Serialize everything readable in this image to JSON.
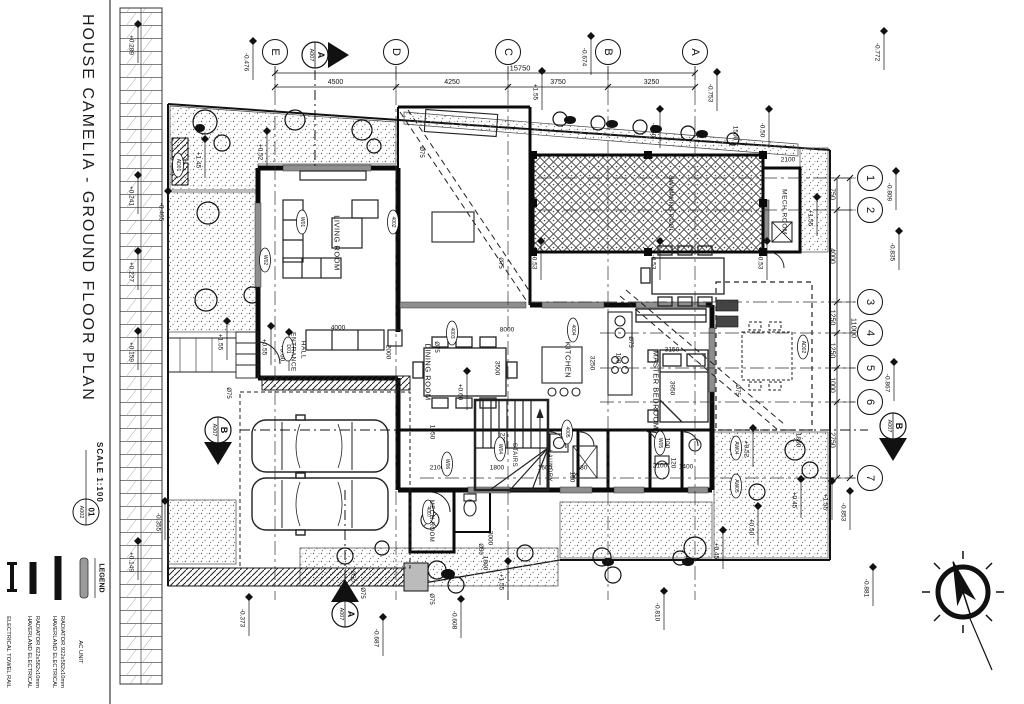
{
  "sheet": {
    "title": "HOUSE CAMELIA  -  GROUND FLOOR PLAN",
    "scale_label": "SCALE 1:100",
    "drawing_number": "01",
    "sheet_code": "A002"
  },
  "legend": {
    "title": "LEGEND",
    "items": [
      {
        "symbol": "ac-unit",
        "x": 84,
        "label_lines": [
          "AC UNIT"
        ]
      },
      {
        "symbol": "radiator-922",
        "x": 58,
        "label_lines": [
          "HAVERLAND ELECTRICAL",
          "RADIATOR 922x582x10mm"
        ]
      },
      {
        "symbol": "radiator-622",
        "x": 33,
        "label_lines": [
          "HAVERLAND ELECTRICAL",
          "RADIATOR 622x582x10mm"
        ]
      },
      {
        "symbol": "towel-rail",
        "x": 12,
        "label_lines": [
          "ELECTRICAL TOWEL RAIL"
        ]
      }
    ]
  },
  "grid": {
    "columns": [
      {
        "label": "E",
        "x": 275
      },
      {
        "label": "D",
        "x": 396
      },
      {
        "label": "C",
        "x": 508
      },
      {
        "label": "B",
        "x": 608
      },
      {
        "label": "A",
        "x": 695
      }
    ],
    "rows": [
      {
        "label": "1",
        "y": 178,
        "x1": 538
      },
      {
        "label": "2",
        "y": 210,
        "x1": 538
      },
      {
        "label": "3",
        "y": 302,
        "x1": 528
      },
      {
        "label": "4",
        "y": 333,
        "x1": 600
      },
      {
        "label": "5",
        "y": 368,
        "x1": 600
      },
      {
        "label": "6",
        "y": 402,
        "x1": 600
      },
      {
        "label": "7",
        "y": 478,
        "x1": 420
      }
    ]
  },
  "dimensions": {
    "top_total": "15750",
    "top_segments": [
      "4500",
      "4250",
      "3750",
      "3250"
    ],
    "right_total": "11000",
    "right_segments": [
      "750",
      "4000",
      "1250",
      "1250",
      "1000",
      "2750"
    ],
    "interior": [
      {
        "t": "8000",
        "x": 507,
        "y": 330,
        "o": "h"
      },
      {
        "t": "4000",
        "x": 338,
        "y": 328,
        "o": "h"
      },
      {
        "t": "2000",
        "x": 388,
        "y": 352,
        "o": "v"
      },
      {
        "t": "3500",
        "x": 497,
        "y": 368,
        "o": "v"
      },
      {
        "t": "3250",
        "x": 592,
        "y": 363,
        "o": "v"
      },
      {
        "t": "3150",
        "x": 672,
        "y": 350,
        "o": "h"
      },
      {
        "t": "3950",
        "x": 672,
        "y": 388,
        "o": "v"
      },
      {
        "t": "1050",
        "x": 432,
        "y": 432,
        "o": "v"
      },
      {
        "t": "2100",
        "x": 437,
        "y": 468,
        "o": "h"
      },
      {
        "t": "1800",
        "x": 497,
        "y": 468,
        "o": "h"
      },
      {
        "t": "1600",
        "x": 545,
        "y": 468,
        "o": "h"
      },
      {
        "t": "680",
        "x": 582,
        "y": 468,
        "o": "h"
      },
      {
        "t": "100",
        "x": 572,
        "y": 477,
        "o": "v"
      },
      {
        "t": "100",
        "x": 618,
        "y": 358,
        "o": "v"
      },
      {
        "t": "100",
        "x": 667,
        "y": 443,
        "o": "v"
      },
      {
        "t": "1800",
        "x": 798,
        "y": 440,
        "o": "v"
      },
      {
        "t": "2100",
        "x": 660,
        "y": 466,
        "o": "h"
      },
      {
        "t": "1400",
        "x": 686,
        "y": 467,
        "o": "h"
      },
      {
        "t": "120",
        "x": 673,
        "y": 463,
        "o": "v"
      },
      {
        "t": "3000",
        "x": 490,
        "y": 538,
        "o": "v"
      },
      {
        "t": "1800",
        "x": 485,
        "y": 563,
        "o": "v"
      },
      {
        "t": "1500",
        "x": 735,
        "y": 133,
        "o": "v"
      },
      {
        "t": "2100",
        "x": 788,
        "y": 160,
        "o": "h"
      },
      {
        "t": "2250",
        "x": 502,
        "y": 440,
        "o": "v"
      }
    ]
  },
  "rooms": [
    {
      "name": "LIVING ROOM",
      "x": 337,
      "y": 243,
      "s": 7.5
    },
    {
      "name": "ENTRANCE",
      "x": 293,
      "y": 352,
      "s": 6.5
    },
    {
      "name": "HALL",
      "x": 303,
      "y": 350,
      "s": 6.5
    },
    {
      "name": "DINING ROOM",
      "x": 428,
      "y": 372,
      "s": 7.5
    },
    {
      "name": "KITCHEN",
      "x": 568,
      "y": 360,
      "s": 7.5
    },
    {
      "name": "MASTER BEDROOM",
      "x": 656,
      "y": 390,
      "s": 7.5
    },
    {
      "name": "MECH.ROOM",
      "x": 784,
      "y": 212,
      "s": 6.5
    },
    {
      "name": "MECH.ROOM",
      "x": 431,
      "y": 521,
      "s": 6
    },
    {
      "name": "LAUNDRY",
      "x": 549,
      "y": 466,
      "s": 6
    },
    {
      "name": "STAIRS",
      "x": 514,
      "y": 455,
      "s": 6
    },
    {
      "name": "SWIMMING POOL",
      "x": 670,
      "y": 204,
      "s": 6
    }
  ],
  "levels": [
    {
      "t": "-0.476",
      "x": 248,
      "y": 62
    },
    {
      "t": "-0.674",
      "x": 586,
      "y": 57
    },
    {
      "t": "-0.753",
      "x": 712,
      "y": 93
    },
    {
      "t": "-0.772",
      "x": 879,
      "y": 52
    },
    {
      "t": "-0.809",
      "x": 891,
      "y": 192
    },
    {
      "t": "-0.835",
      "x": 894,
      "y": 252
    },
    {
      "t": "-0.867",
      "x": 889,
      "y": 383
    },
    {
      "t": "-0.853",
      "x": 845,
      "y": 512
    },
    {
      "t": "-0.881",
      "x": 868,
      "y": 588
    },
    {
      "t": "-0.810",
      "x": 659,
      "y": 612
    },
    {
      "t": "-0.687",
      "x": 378,
      "y": 638
    },
    {
      "t": "-0.608",
      "x": 456,
      "y": 620
    },
    {
      "t": "-0.465",
      "x": 163,
      "y": 212
    },
    {
      "t": "-0.373",
      "x": 244,
      "y": 618
    },
    {
      "t": "+0.289",
      "x": 133,
      "y": 45
    },
    {
      "t": "+0.241",
      "x": 133,
      "y": 196
    },
    {
      "t": "+0.227",
      "x": 133,
      "y": 272
    },
    {
      "t": "+0.159",
      "x": 133,
      "y": 352
    },
    {
      "t": "+0.149",
      "x": 133,
      "y": 562
    },
    {
      "t": "-0.355",
      "x": 160,
      "y": 522
    },
    {
      "t": "+1.45",
      "x": 200,
      "y": 160
    },
    {
      "t": "+0.52",
      "x": 262,
      "y": 152
    },
    {
      "t": "+0.52",
      "x": 748,
      "y": 449
    },
    {
      "t": "+0.45",
      "x": 796,
      "y": 500
    },
    {
      "t": "+0.45",
      "x": 718,
      "y": 551
    },
    {
      "t": "+0.50",
      "x": 753,
      "y": 527
    },
    {
      "t": "+0.55",
      "x": 266,
      "y": 347
    },
    {
      "t": "+0.60",
      "x": 284,
      "y": 353
    },
    {
      "t": "+0.60",
      "x": 462,
      "y": 392
    },
    {
      "t": "-0.53",
      "x": 536,
      "y": 262
    },
    {
      "t": "-0.53",
      "x": 655,
      "y": 262
    },
    {
      "t": "-0.53",
      "x": 762,
      "y": 262
    },
    {
      "t": "-0.50",
      "x": 655,
      "y": 130
    },
    {
      "t": "-0.50",
      "x": 764,
      "y": 130
    },
    {
      "t": "+1.55",
      "x": 222,
      "y": 342
    },
    {
      "t": "+1.55",
      "x": 537,
      "y": 92
    },
    {
      "t": "+1.55",
      "x": 812,
      "y": 218
    },
    {
      "t": "+1.55",
      "x": 827,
      "y": 502
    },
    {
      "t": "+1.55",
      "x": 503,
      "y": 582
    }
  ],
  "pipe_tags": [
    {
      "t": "Ø75",
      "x": 421,
      "y": 152
    },
    {
      "t": "Ø75",
      "x": 436,
      "y": 347
    },
    {
      "t": "Ø75",
      "x": 500,
      "y": 263
    },
    {
      "t": "Ø75",
      "x": 630,
      "y": 342
    },
    {
      "t": "Ø75",
      "x": 737,
      "y": 390
    },
    {
      "t": "Ø75",
      "x": 228,
      "y": 393
    },
    {
      "t": "Ø75",
      "x": 362,
      "y": 593
    },
    {
      "t": "Ø75",
      "x": 431,
      "y": 599
    },
    {
      "t": "Ø50",
      "x": 352,
      "y": 576
    },
    {
      "t": "Ø50",
      "x": 480,
      "y": 549
    }
  ],
  "element_tags": [
    {
      "t": "W01",
      "x": 302,
      "y": 222
    },
    {
      "t": "W02",
      "x": 265,
      "y": 260
    },
    {
      "t": "4002",
      "x": 393,
      "y": 222
    },
    {
      "t": "4003",
      "x": 452,
      "y": 333
    },
    {
      "t": "4004",
      "x": 573,
      "y": 330
    },
    {
      "t": "4005",
      "x": 567,
      "y": 432
    },
    {
      "t": "W04",
      "x": 500,
      "y": 449
    },
    {
      "t": "W06",
      "x": 447,
      "y": 464
    },
    {
      "t": "4007",
      "x": 428,
      "y": 512
    },
    {
      "t": "AD01",
      "x": 178,
      "y": 165
    },
    {
      "t": "AD02",
      "x": 803,
      "y": 347
    },
    {
      "t": "AW04",
      "x": 736,
      "y": 448
    },
    {
      "t": "AW05",
      "x": 736,
      "y": 486
    },
    {
      "t": "W05",
      "x": 660,
      "y": 443
    },
    {
      "t": "D01",
      "x": 288,
      "y": 349
    }
  ],
  "section_markers": [
    {
      "letter": "A",
      "sheet": "A007",
      "x": 315,
      "y": 55,
      "dir": "right"
    },
    {
      "letter": "A",
      "sheet": "A007",
      "x": 345,
      "y": 614,
      "dir": "up"
    },
    {
      "letter": "B",
      "sheet": "A007",
      "x": 218,
      "y": 430,
      "dir": "down"
    },
    {
      "letter": "B",
      "sheet": "A007",
      "x": 893,
      "y": 426,
      "dir": "down"
    }
  ]
}
